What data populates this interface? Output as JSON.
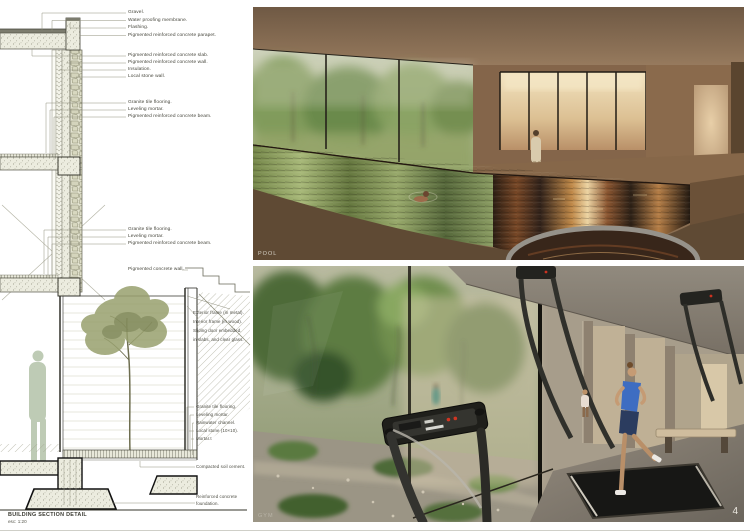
{
  "sheet": {
    "page_number": "4",
    "section_detail": {
      "title": "BUILDING SECTION DETAIL",
      "scale": "esc: 1:20",
      "labels": [
        "Gravel.",
        "Water proofing membrane.",
        "Flashing.",
        "Pigmented reinforced concrete parapet.",
        "Pigmented reinforced concrete slab.",
        "Pigmented reinforced concrete wall.",
        "Insulation.",
        "Local stone wall.",
        "Granite tile flooring.",
        "Leveling mortar.",
        "Pigmented reinforced concrete beam.",
        "Granite tile flooring.",
        "Leveling mortar.",
        "Pigmented reinforced concrete beam.",
        "Pigmented concrete wall.",
        "Exterior frame (in metal).",
        "Interior frame (in wood).",
        "Sliding door embedded.",
        "in slabs, and clear glass.",
        "Granite tile flooring.",
        "Leveling mortar.",
        "Rainwater channel.",
        "Local stone (10×10).",
        "Mortar.t",
        "Compacted soil cement.",
        "Reinforced concrete",
        "foundation."
      ]
    },
    "renders": {
      "pool": {
        "caption": "POOL"
      },
      "gym": {
        "caption": "GYM"
      }
    },
    "colors": {
      "paper": "#ffffff",
      "ink": "#46463c",
      "stone_fill": "#dcdcc6",
      "tree_olive": "#8f9a66",
      "figure_sage": "#b7c6ae",
      "pool_ceiling_brown": "#8a6f54",
      "pool_water_green": "#8a9c62",
      "pool_water_amber": "#bf8848",
      "gym_tree_green": "#5d7c42",
      "caption_gray": "#d5d0c5"
    }
  }
}
